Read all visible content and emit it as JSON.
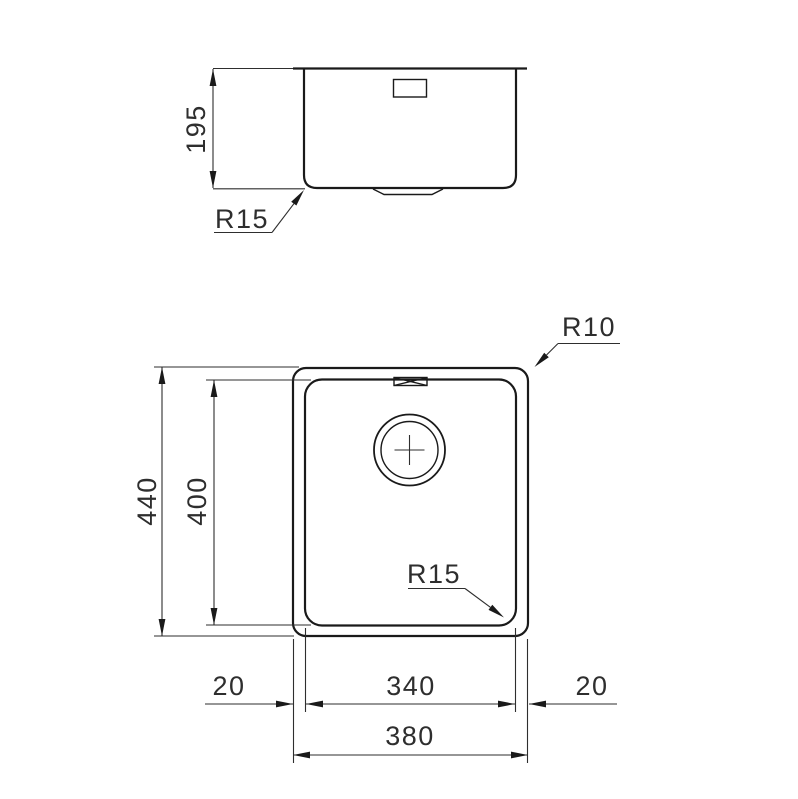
{
  "drawing": {
    "background": "#ffffff",
    "line_color": "#1a1a1a",
    "dimension_color": "#2e2e2e",
    "side_view": {
      "height": "195",
      "corner_radius": "R15"
    },
    "plan_view": {
      "overall_depth": "440",
      "bowl_depth": "400",
      "outer_corner_radius": "R10",
      "bowl_corner_radius": "R15",
      "left_rim": "20",
      "bowl_width": "340",
      "right_rim": "20",
      "overall_width": "380"
    }
  }
}
